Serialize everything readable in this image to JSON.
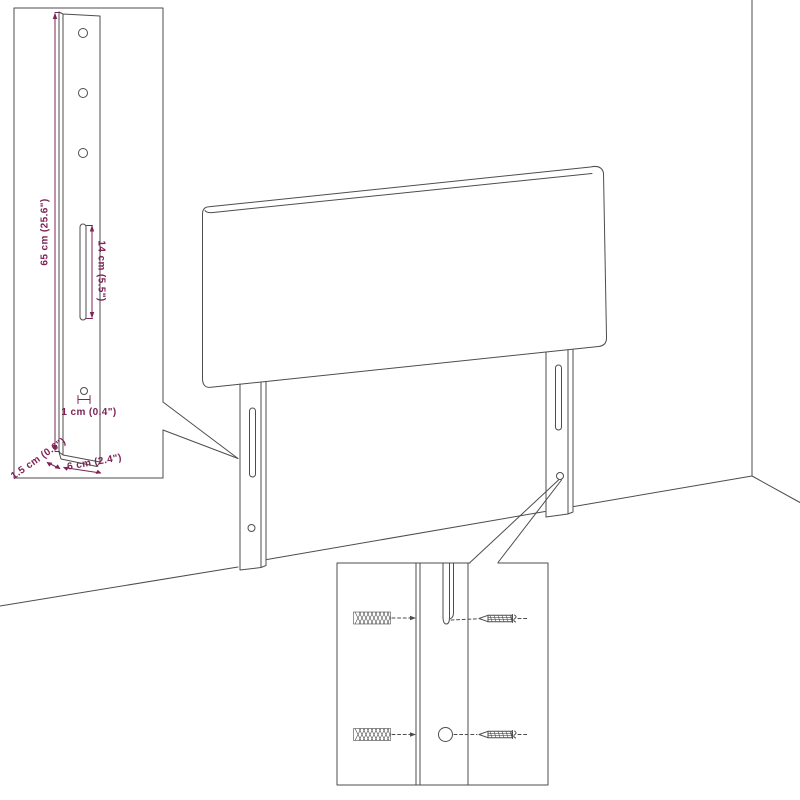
{
  "diagram": {
    "kind": "product-assembly-line-drawing",
    "subject": "headboard mounted against wall corner",
    "palette": {
      "line": "#4d4d4d",
      "dimension": "#7d2457",
      "background": "#ffffff"
    },
    "bracket_inset": {
      "description": "enlarged headboard leg bracket with dimensions",
      "dim_height": "65 cm (25.6\")",
      "dim_slot_length": "14 cm (5.5\")",
      "dim_hole_diameter": "1 cm (0.4\")",
      "dim_thickness": "1.5 cm (0.6\")",
      "dim_width": "6 cm (2.4\")"
    },
    "mounting_inset": {
      "description": "close-up of leg slot and hole with wall plugs and screws",
      "hardware": [
        "wall-plug",
        "screw"
      ]
    }
  }
}
